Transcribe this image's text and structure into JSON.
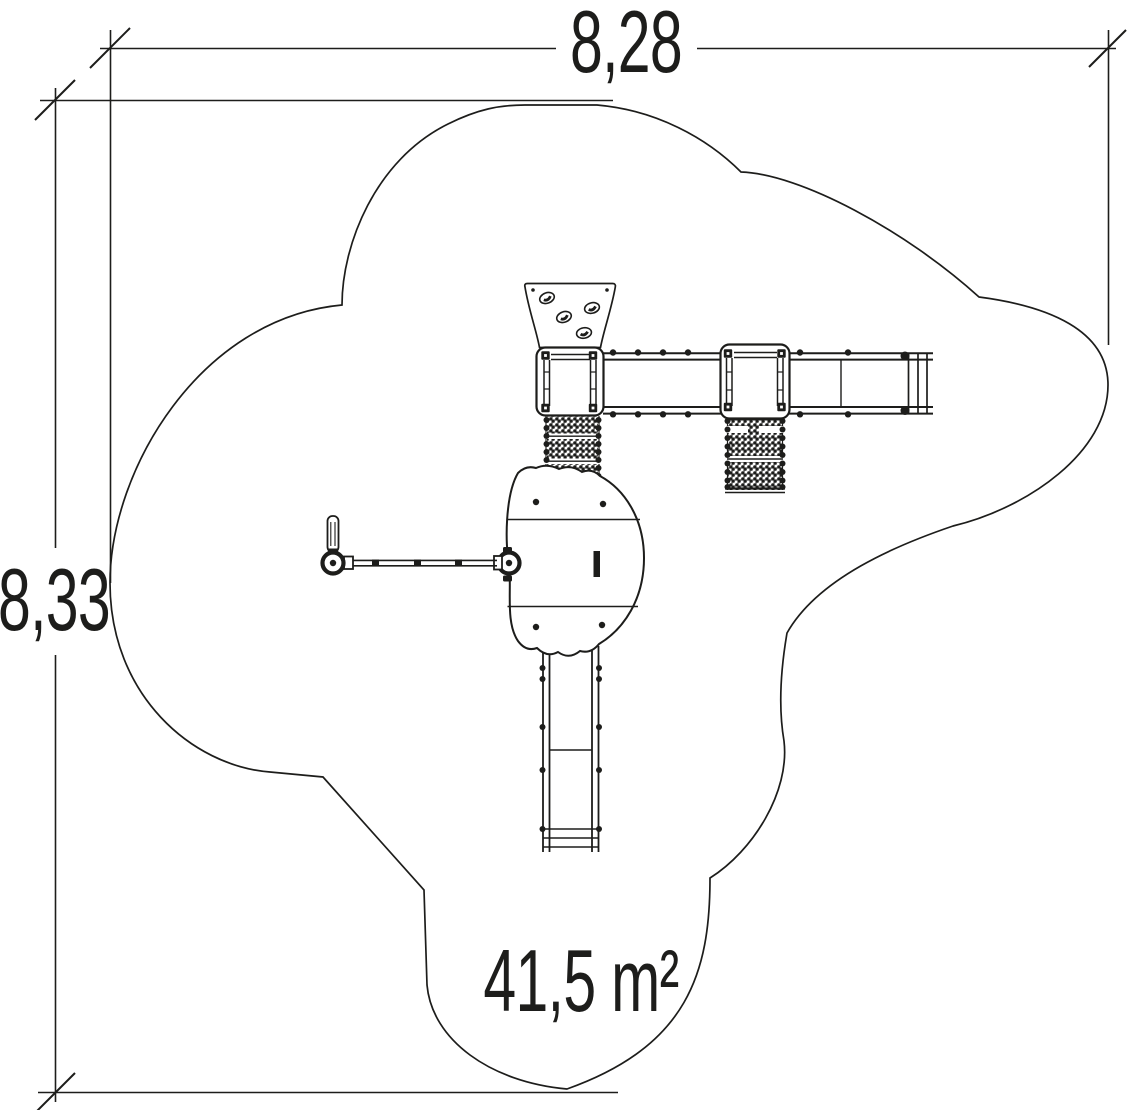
{
  "labels": {
    "width": "8,28",
    "height": "8,33",
    "area": "41,5 m²"
  },
  "colors": {
    "ink": "#1d1d1b",
    "background": "#ffffff"
  },
  "drawing": {
    "components": [
      "safety-zone-outline",
      "width-dimension",
      "height-dimension",
      "climbing-wall",
      "tower-platform-1",
      "bridge-1",
      "tower-platform-2",
      "bridge-2",
      "net-ramp-1",
      "net-ramp-2",
      "activity-pod",
      "swing-arm",
      "slide"
    ]
  }
}
